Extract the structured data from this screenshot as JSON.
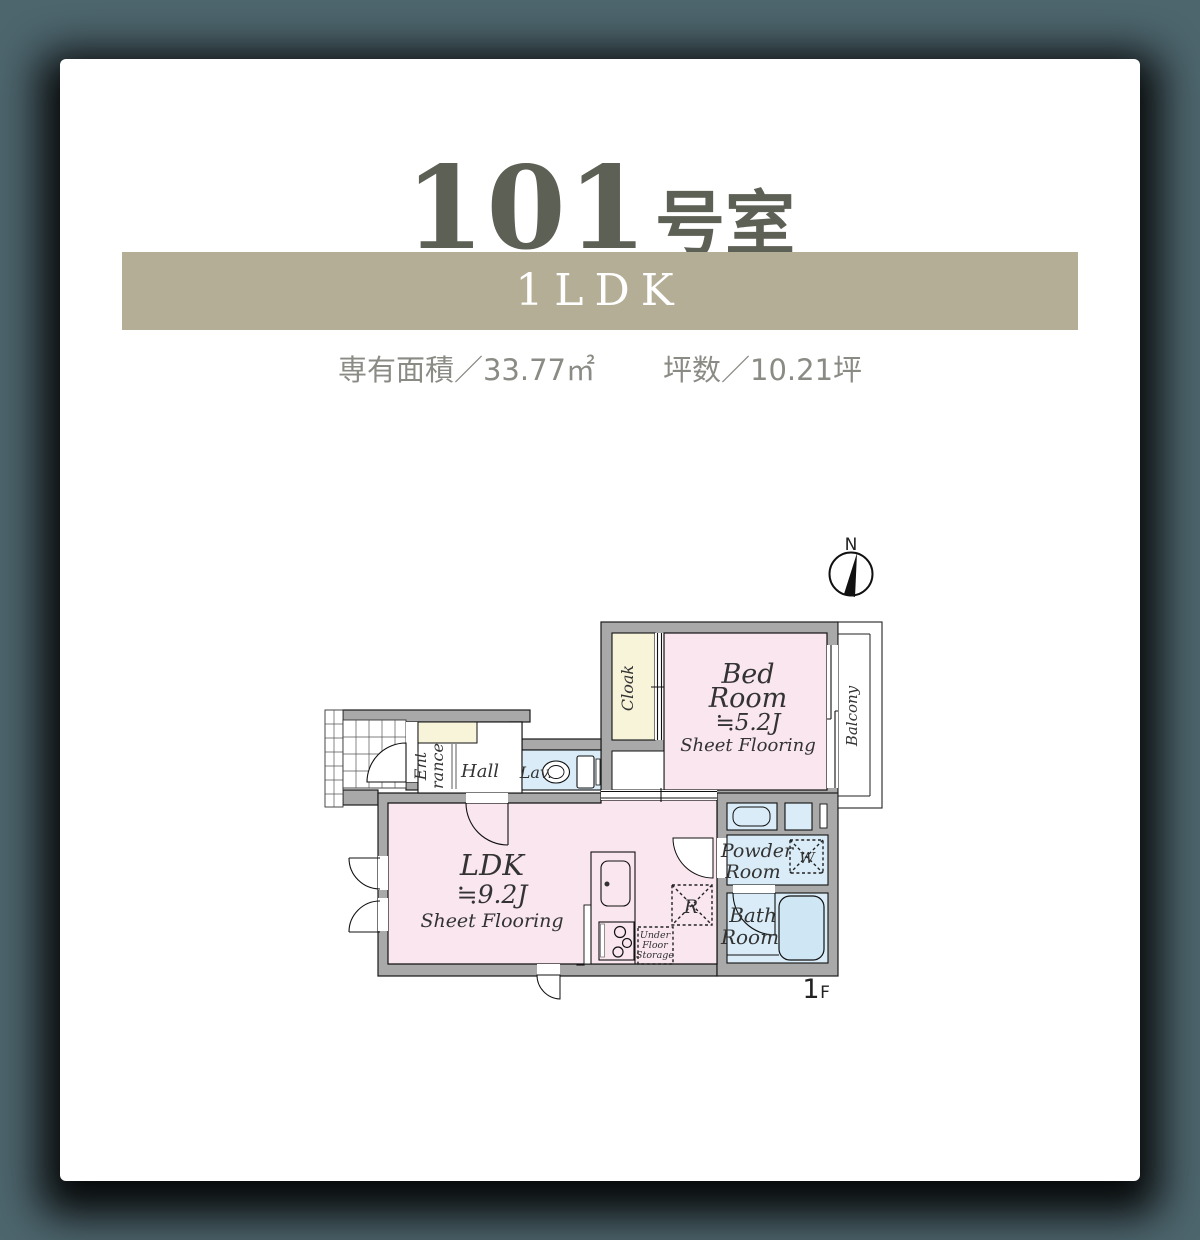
{
  "page": {
    "background": "#4d656d",
    "card_background": "#ffffff"
  },
  "header": {
    "room_number": "101",
    "room_suffix": "号室",
    "title_color": "#5d6055",
    "type_label": "1LDK",
    "band_background": "#b5ae96",
    "area_label": "専有面積／33.77㎡",
    "tsubo_label": "坪数／10.21坪"
  },
  "floorplan": {
    "wall_color": "#a9a9a9",
    "floor_label": {
      "number": "1",
      "suffix": "F"
    },
    "compass": {
      "label": "N"
    },
    "rooms": {
      "bedroom": {
        "name_line1": "Bed",
        "name_line2": "Room",
        "size": "≒5.2J",
        "flooring": "Sheet Flooring",
        "color": "#f9e6ef"
      },
      "ldk": {
        "name": "LDK",
        "size": "≒9.2J",
        "flooring": "Sheet Flooring",
        "color": "#f9e6ef"
      },
      "cloak": {
        "name": "Cloak",
        "color": "#f8f4da"
      },
      "balcony": {
        "name": "Balcony"
      },
      "entrance": {
        "name_line1": "Ent",
        "name_line2": "rance"
      },
      "hall": {
        "name": "Hall"
      },
      "lav": {
        "name": "Lav."
      },
      "powder_room": {
        "name_line1": "Powder",
        "name_line2": "Room",
        "color": "#d9ecf7"
      },
      "bath_room": {
        "name_line1": "Bath",
        "name_line2": "Room",
        "color": "#d9ecf7"
      },
      "washer": {
        "label": "W"
      },
      "refrigerator": {
        "label": "R"
      },
      "under_floor_storage": {
        "line1": "Under",
        "line2": "Floor",
        "line3": "Storage"
      }
    },
    "fixtures": {
      "tub_color": "#cfe7f4"
    }
  }
}
